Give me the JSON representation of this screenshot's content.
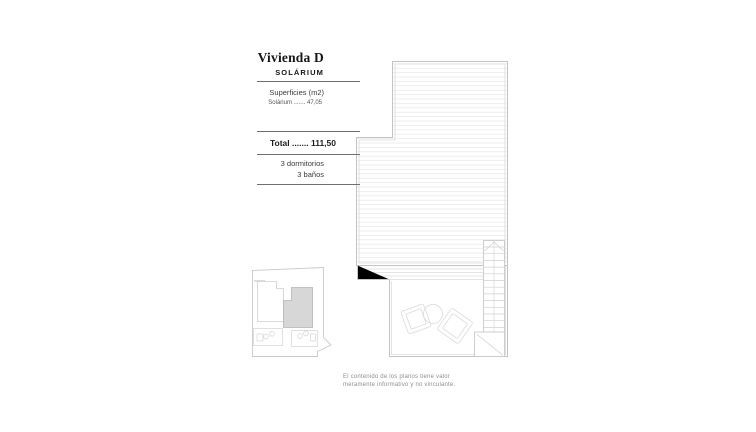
{
  "info_panel": {
    "title": "Vivienda D",
    "subtitle": "SOLÁRIUM",
    "surfaces_heading": "Superficies (m2)",
    "surface_row": {
      "label": "Solárium",
      "leader": ".......",
      "value": "47,05"
    },
    "total_row": {
      "label": "Total",
      "leader": ".......",
      "value": "111,50"
    },
    "features": [
      "3 dormitorios",
      "3 baños"
    ]
  },
  "disclaimer": {
    "line1": "El contenido de los planos tiene valor",
    "line2": "meramente informativo y no vinculante."
  },
  "drawing": {
    "main_plan": "solarium-roof-terrace-plan",
    "key_plan": "site-key-plan-with-unit-highlighted"
  },
  "colors": {
    "background": "#ffffff",
    "rule": "#6f6f6f",
    "plan_line": "#c3c3c3",
    "plan_line_light": "#dbdbdb",
    "hatch_line": "#e6e6e6",
    "unit_highlight_fill": "#d7d7d7",
    "text_dark": "#161616",
    "text_muted": "#8f8f8f"
  }
}
